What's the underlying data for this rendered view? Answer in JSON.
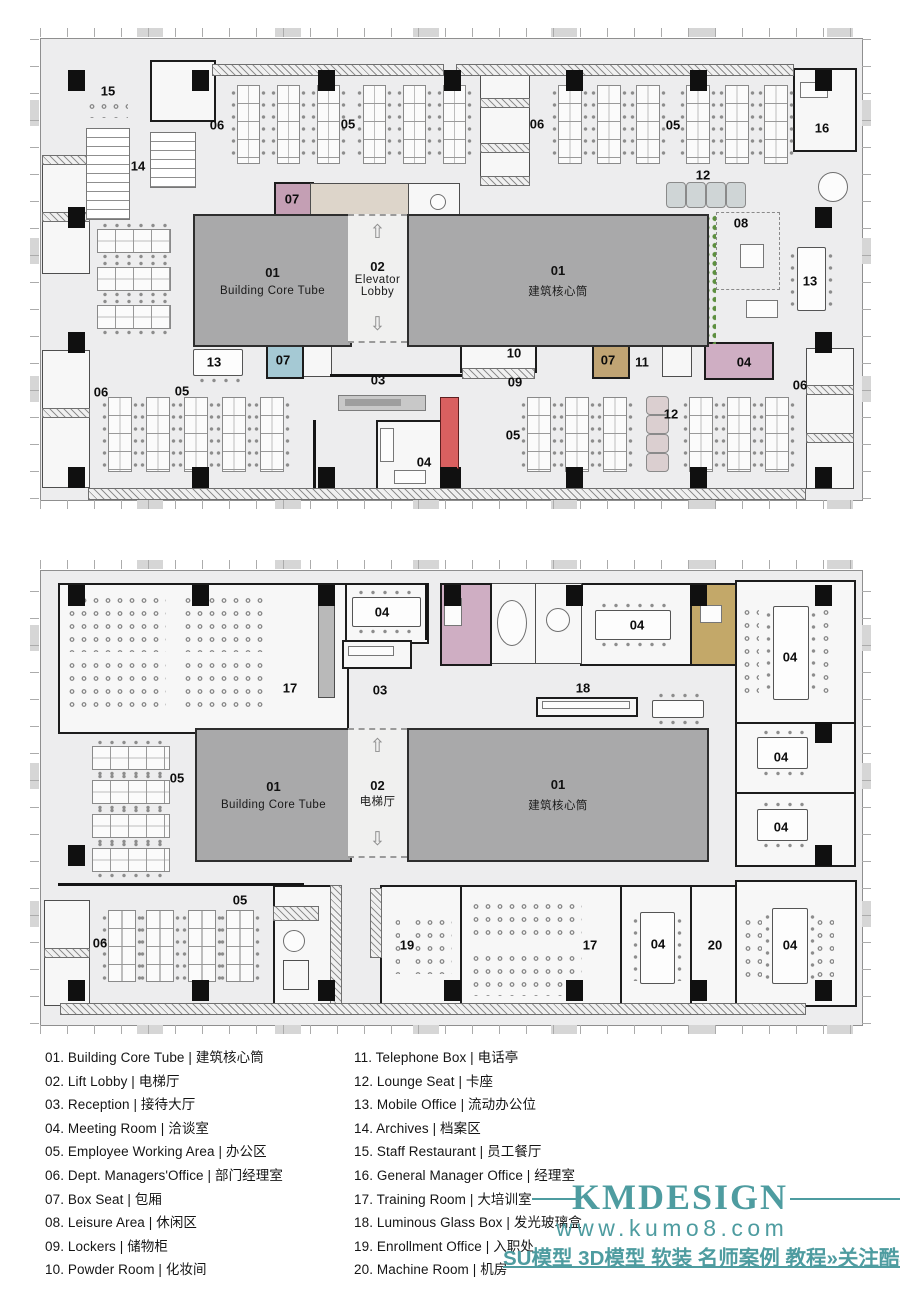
{
  "colors": {
    "accent_teal": "#4e9ca0",
    "core_gray": "#a9a9aa",
    "floor": "#ededee",
    "pink_room": "#cfaec3",
    "pink_box": "#c49fb4",
    "blue_box": "#a5c9d4",
    "tan_box": "#c0a474",
    "tan_room": "#c3a869",
    "beige": "#ddd5ca",
    "red_accent": "#d96060",
    "plant_green": "#5d8f3f"
  },
  "plan1": {
    "core_left": {
      "num": "01",
      "name": "Building Core Tube"
    },
    "lobby": {
      "num": "02",
      "line1": "Elevator",
      "line2": "Lobby",
      "up_icon": "⇧",
      "down_icon": "⇩"
    },
    "core_right": {
      "num": "01",
      "name": "建筑核心筒"
    },
    "labels": [
      {
        "t": "15",
        "x": 108,
        "y": 91
      },
      {
        "t": "14",
        "x": 138,
        "y": 166
      },
      {
        "t": "06",
        "x": 217,
        "y": 125
      },
      {
        "t": "05",
        "x": 348,
        "y": 124
      },
      {
        "t": "06",
        "x": 537,
        "y": 124
      },
      {
        "t": "05",
        "x": 673,
        "y": 125
      },
      {
        "t": "16",
        "x": 822,
        "y": 128
      },
      {
        "t": "12",
        "x": 703,
        "y": 175
      },
      {
        "t": "08",
        "x": 741,
        "y": 223
      },
      {
        "t": "07",
        "x": 292,
        "y": 199
      },
      {
        "t": "13",
        "x": 810,
        "y": 281
      },
      {
        "t": "07",
        "x": 283,
        "y": 360
      },
      {
        "t": "13",
        "x": 214,
        "y": 362
      },
      {
        "t": "07",
        "x": 608,
        "y": 360
      },
      {
        "t": "11",
        "x": 642,
        "y": 362
      },
      {
        "t": "04",
        "x": 744,
        "y": 362
      },
      {
        "t": "10",
        "x": 514,
        "y": 353
      },
      {
        "t": "09",
        "x": 515,
        "y": 382
      },
      {
        "t": "03",
        "x": 378,
        "y": 380
      },
      {
        "t": "06",
        "x": 101,
        "y": 392
      },
      {
        "t": "05",
        "x": 182,
        "y": 391
      },
      {
        "t": "04",
        "x": 424,
        "y": 462
      },
      {
        "t": "05",
        "x": 513,
        "y": 435
      },
      {
        "t": "12",
        "x": 671,
        "y": 414
      },
      {
        "t": "06",
        "x": 800,
        "y": 385
      }
    ]
  },
  "plan2": {
    "core_left": {
      "num": "01",
      "name": "Building Core Tube"
    },
    "lobby": {
      "num": "02",
      "line1": "电梯厅",
      "line2": "",
      "up_icon": "⇧",
      "down_icon": "⇩"
    },
    "core_right": {
      "num": "01",
      "name": "建筑核心筒"
    },
    "labels": [
      {
        "t": "17",
        "x": 290,
        "y": 688
      },
      {
        "t": "04",
        "x": 382,
        "y": 612
      },
      {
        "t": "03",
        "x": 380,
        "y": 690
      },
      {
        "t": "04",
        "x": 637,
        "y": 625
      },
      {
        "t": "04",
        "x": 790,
        "y": 657
      },
      {
        "t": "04",
        "x": 781,
        "y": 757
      },
      {
        "t": "04",
        "x": 781,
        "y": 827
      },
      {
        "t": "18",
        "x": 583,
        "y": 688
      },
      {
        "t": "05",
        "x": 177,
        "y": 778
      },
      {
        "t": "05",
        "x": 240,
        "y": 900
      },
      {
        "t": "06",
        "x": 100,
        "y": 943
      },
      {
        "t": "19",
        "x": 407,
        "y": 945
      },
      {
        "t": "17",
        "x": 590,
        "y": 945
      },
      {
        "t": "04",
        "x": 658,
        "y": 944
      },
      {
        "t": "20",
        "x": 715,
        "y": 945
      },
      {
        "t": "04",
        "x": 790,
        "y": 945
      }
    ]
  },
  "legend": {
    "left": [
      {
        "n": "01",
        "en": "Building Core Tube",
        "zh": "建筑核心筒"
      },
      {
        "n": "02",
        "en": "Lift Lobby",
        "zh": "电梯厅"
      },
      {
        "n": "03",
        "en": "Reception",
        "zh": "接待大厅"
      },
      {
        "n": "04",
        "en": "Meeting Room",
        "zh": "洽谈室"
      },
      {
        "n": "05",
        "en": "Employee Working Area",
        "zh": "办公区"
      },
      {
        "n": "06",
        "en": "Dept. Managers'Office",
        "zh": "部门经理室"
      },
      {
        "n": "07",
        "en": "Box Seat",
        "zh": "包厢"
      },
      {
        "n": "08",
        "en": "Leisure Area",
        "zh": "休闲区"
      },
      {
        "n": "09",
        "en": "Lockers",
        "zh": "储物柜"
      },
      {
        "n": "10",
        "en": "Powder Room",
        "zh": "化妆间"
      }
    ],
    "right": [
      {
        "n": "11",
        "en": "Telephone Box",
        "zh": "电话亭"
      },
      {
        "n": "12",
        "en": "Lounge Seat",
        "zh": "卡座"
      },
      {
        "n": "13",
        "en": "Mobile Office",
        "zh": "流动办公位"
      },
      {
        "n": "14",
        "en": "Archives",
        "zh": "档案区"
      },
      {
        "n": "15",
        "en": "Staff Restaurant",
        "zh": "员工餐厅"
      },
      {
        "n": "16",
        "en": "General Manager Office",
        "zh": "经理室"
      },
      {
        "n": "17",
        "en": "Training Room",
        "zh": "大培训室"
      },
      {
        "n": "18",
        "en": "Luminous Glass Box",
        "zh": "发光玻璃盒"
      },
      {
        "n": "19",
        "en": "Enrollment Office",
        "zh": "入职处"
      },
      {
        "n": "20",
        "en": "Machine Room",
        "zh": "机房"
      }
    ]
  },
  "watermark": {
    "brand": "KMDESIGN",
    "url": "www.kumo8.com",
    "footer": "SU模型 3D模型 软装 名师案例 教程»关注酷模吧"
  }
}
